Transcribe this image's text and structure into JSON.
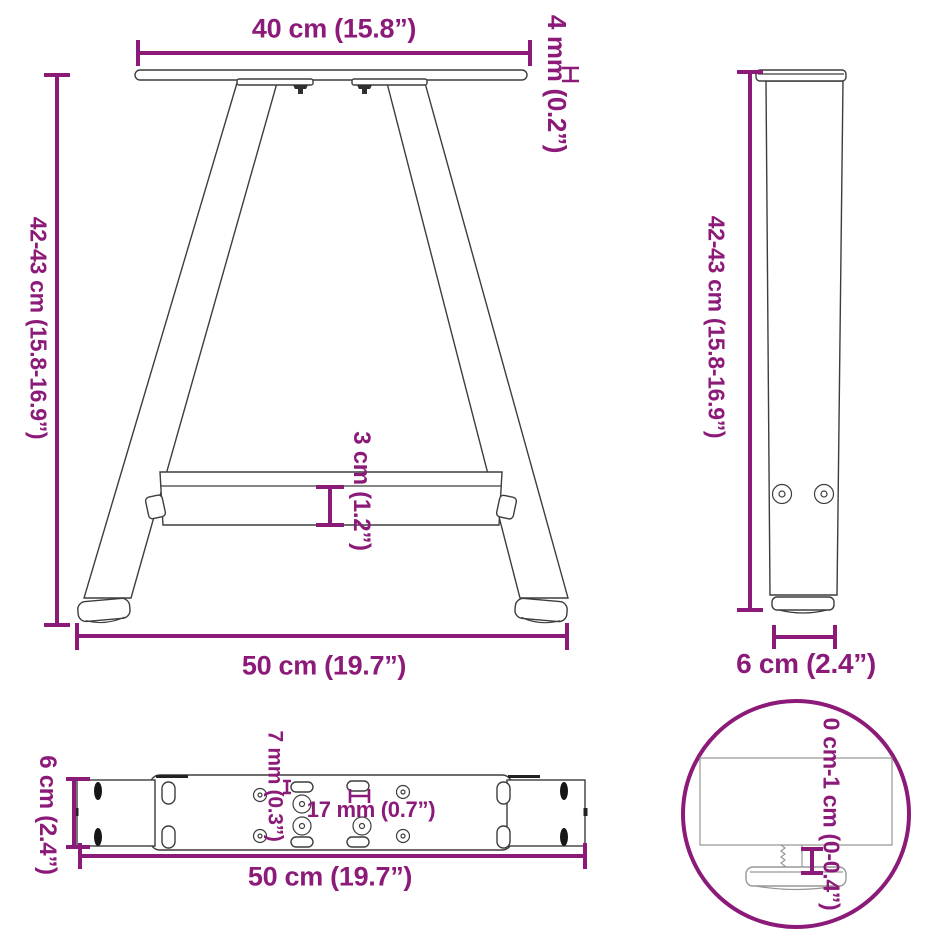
{
  "colors": {
    "dimension_accent": "#8C1A79",
    "line": "#3D3D3D"
  },
  "front_view": {
    "labels": {
      "top_width": "40 cm (15.8”)",
      "plate_thickness": "4 mm (0.2”)",
      "height": "42-43 cm (15.8-16.9”)",
      "crossbar_height": "3 cm (1.2”)",
      "bottom_width": "50 cm (19.7”)"
    }
  },
  "side_view": {
    "labels": {
      "height": "42-43 cm (15.8-16.9”)",
      "foot_width": "6 cm (2.4”)"
    }
  },
  "plate_view": {
    "labels": {
      "depth": "6 cm (2.4”)",
      "small_hole": "7 mm (0.3”)",
      "large_hole": "17 mm (0.7”)",
      "length": "50 cm (19.7”)"
    }
  },
  "detail_view": {
    "labels": {
      "height_adjustment": "0 cm-1 cm (0-0.4”)"
    }
  }
}
